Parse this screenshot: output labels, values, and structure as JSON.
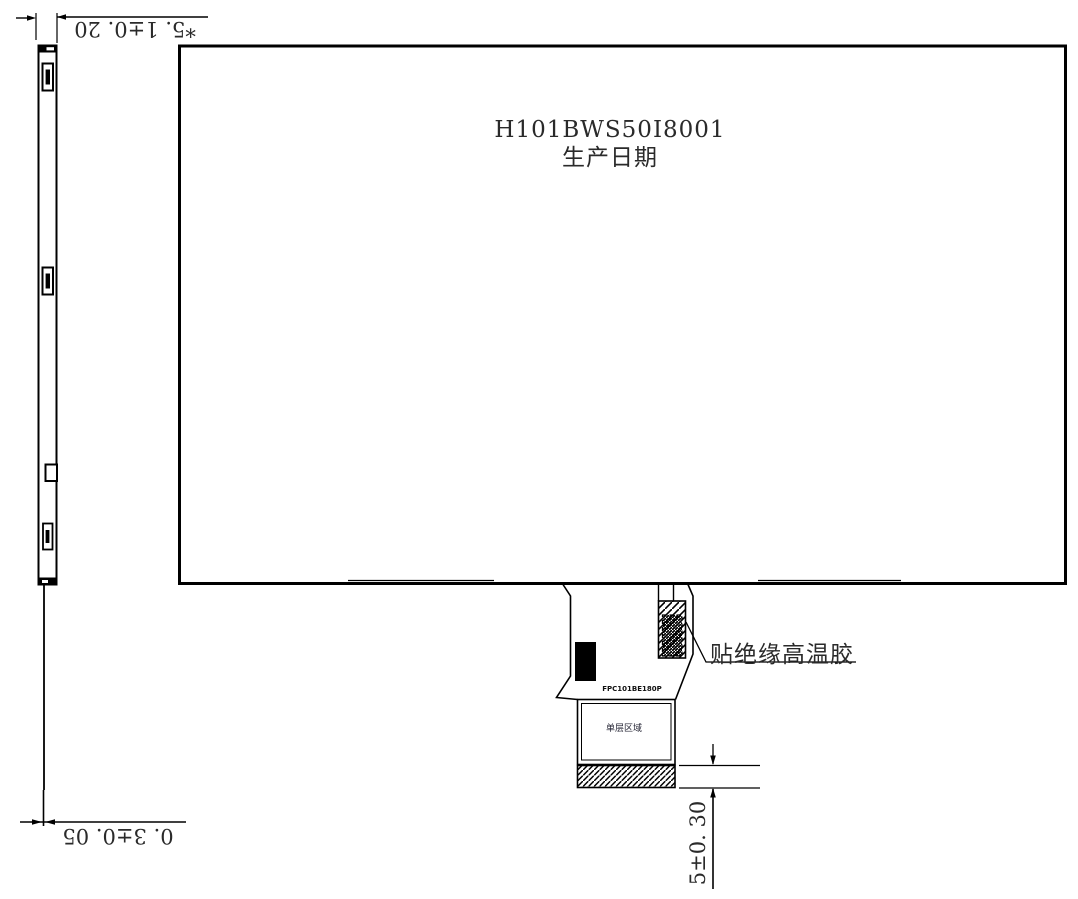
{
  "front_view": {
    "model": "H101BWS50I8001",
    "date_label": "生产日期"
  },
  "fpc": {
    "part_number": "FPC101BE180P",
    "area_label": "单层区域",
    "tape_note": "贴绝缘高温胶"
  },
  "dimensions": {
    "side_thickness": "*5. 1±0. 20",
    "fpc_thickness": "0. 3±0. 05",
    "connector_height": "5±0. 30"
  },
  "colors": {
    "line": "#000000",
    "text": "#2a2a2a",
    "background": "#ffffff"
  }
}
